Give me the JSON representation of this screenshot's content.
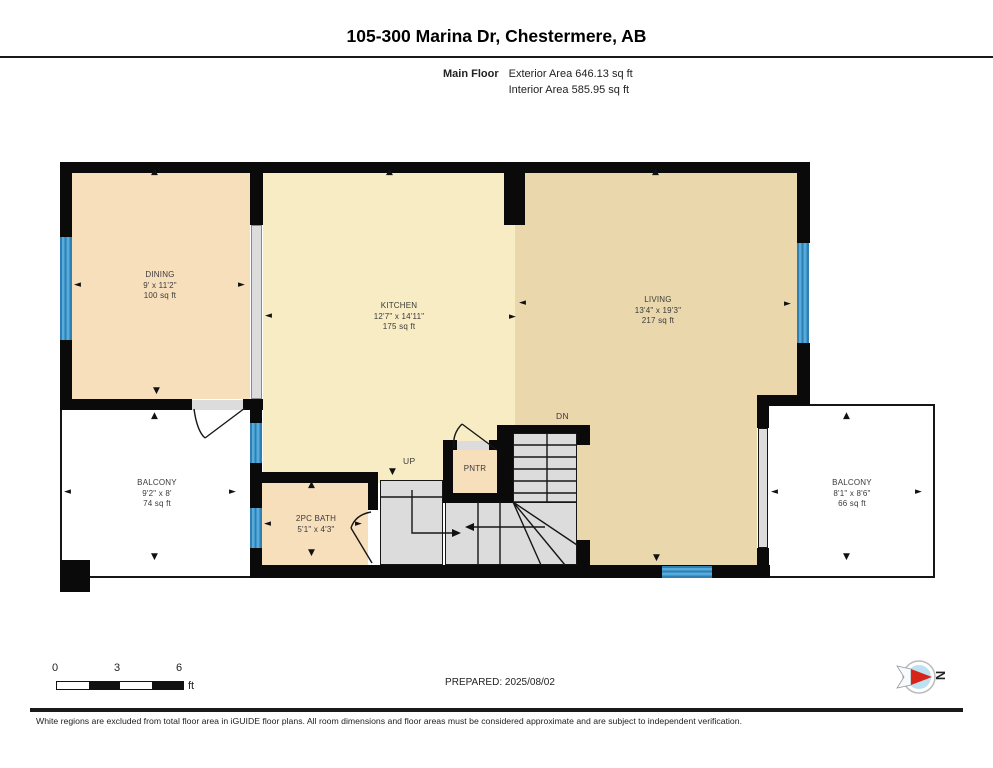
{
  "header": {
    "title": "105-300 Marina Dr, Chestermere, AB",
    "floor_label": "Main Floor",
    "exterior_area": "Exterior Area 646.13 sq ft",
    "interior_area": "Interior Area 585.95 sq ft"
  },
  "rooms": {
    "dining": {
      "name": "DINING",
      "dims": "9' x 11'2\"",
      "area": "100 sq ft"
    },
    "kitchen": {
      "name": "KITCHEN",
      "dims": "12'7\" x 14'11\"",
      "area": "175 sq ft"
    },
    "living": {
      "name": "LIVING",
      "dims": "13'4\" x 19'3\"",
      "area": "217 sq ft"
    },
    "balcony_left": {
      "name": "BALCONY",
      "dims": "9'2\" x 8'",
      "area": "74 sq ft"
    },
    "bath": {
      "name": "2PC BATH",
      "dims": "5'1\" x 4'3\""
    },
    "pantry": {
      "name": "PNTR"
    },
    "balcony_right": {
      "name": "BALCONY",
      "dims": "8'1\" x 8'6\"",
      "area": "66 sq ft"
    }
  },
  "stairs": {
    "up": "UP",
    "down": "DN"
  },
  "symbols": {
    "up": "▲",
    "down": "▼",
    "left": "◄",
    "right": "►"
  },
  "scale_bar": {
    "ticks": [
      "0",
      "3",
      "6"
    ],
    "unit": "ft"
  },
  "prepared": "PREPARED: 2025/08/02",
  "compass": {
    "north": "N"
  },
  "footer": "White regions are excluded from total floor area in iGUIDE floor plans. All room dimensions and floor areas must be considered approximate and are subject to independent verification.",
  "colors": {
    "room_warm": "#F8DFBC",
    "room_pale": "#F7ECC4",
    "room_tan": "#EAD8AC",
    "window_blue": "#56ABDC",
    "wall_black": "#0A0A0A",
    "stair_gray": "#DCDCDC",
    "compass_red": "#D62518",
    "compass_blue": "#BDE1F2"
  }
}
